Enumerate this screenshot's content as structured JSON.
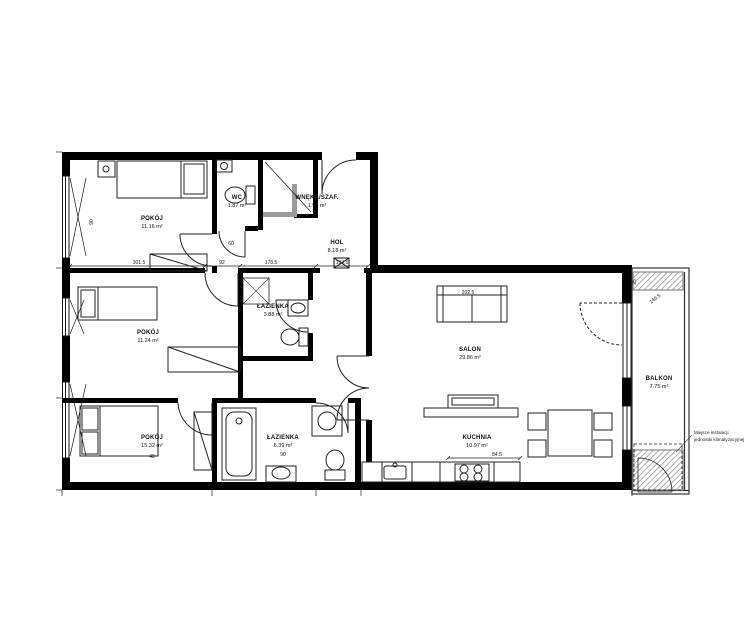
{
  "plan": {
    "rooms": [
      {
        "name": "POKÓJ",
        "area": "11.16 m²"
      },
      {
        "name": "WC",
        "area": "1.87 m²"
      },
      {
        "name": "WNĘKA/SZAF.",
        "area": "1.96 m²"
      },
      {
        "name": "HOL",
        "area": "8.18 m²"
      },
      {
        "name": "POKÓJ",
        "area": "11.24 m²"
      },
      {
        "name": "ŁAZIENKA",
        "area": "3.88 m²"
      },
      {
        "name": "POKÓJ",
        "area": "15.32 m²"
      },
      {
        "name": "ŁAZIENKA",
        "area": "6.39 m²"
      },
      {
        "name": "SALON",
        "area": "29.86 m²"
      },
      {
        "name": "KUCHNIA",
        "area": "10.97 m²"
      },
      {
        "name": "BALKON",
        "area": "7.75 m²"
      }
    ],
    "note": {
      "line1": "Miejsce instalacji",
      "line2": "jednostki klimatyzacyjnej"
    },
    "dims": [
      {
        "v": "301.5"
      },
      {
        "v": "92"
      },
      {
        "v": "178.5"
      },
      {
        "v": "193.5"
      },
      {
        "v": "202.5"
      },
      {
        "v": "84.5"
      },
      {
        "v": "90"
      },
      {
        "v": "48"
      },
      {
        "v": "90"
      },
      {
        "v": "60"
      },
      {
        "v": "25"
      },
      {
        "v": "146.5"
      }
    ],
    "colors": {
      "wall": "#000000",
      "line": "#222222",
      "frame": "#8a8a8a",
      "background": "#ffffff"
    }
  }
}
